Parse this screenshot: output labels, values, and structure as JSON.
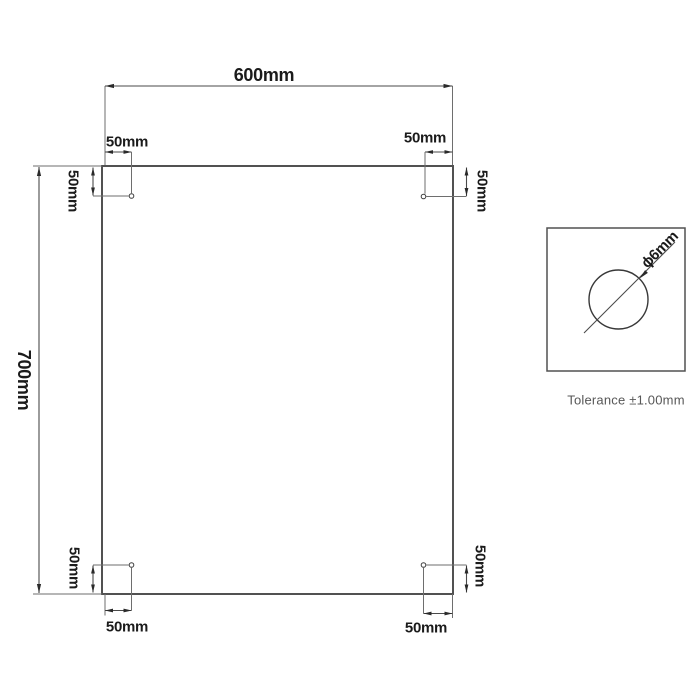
{
  "drawing": {
    "width_label": "600mm",
    "height_label": "700mm",
    "corner_offsets": {
      "top_left": {
        "horizontal": "50mm",
        "vertical": "50mm"
      },
      "top_right": {
        "horizontal": "50mm",
        "vertical": "50mm"
      },
      "bottom_left": {
        "horizontal": "50mm",
        "vertical": "50mm"
      },
      "bottom_right": {
        "horizontal": "50mm",
        "vertical": "50mm"
      }
    },
    "hole_detail": {
      "diameter_label": "ϕ6mm"
    },
    "tolerance_note": "Tolerance ±1.00mm",
    "colors": {
      "line": "#4a4a4a",
      "panel_line": "#515151",
      "text": "#1b1b1b",
      "note_text": "#575757",
      "background": "#ffffff"
    }
  }
}
